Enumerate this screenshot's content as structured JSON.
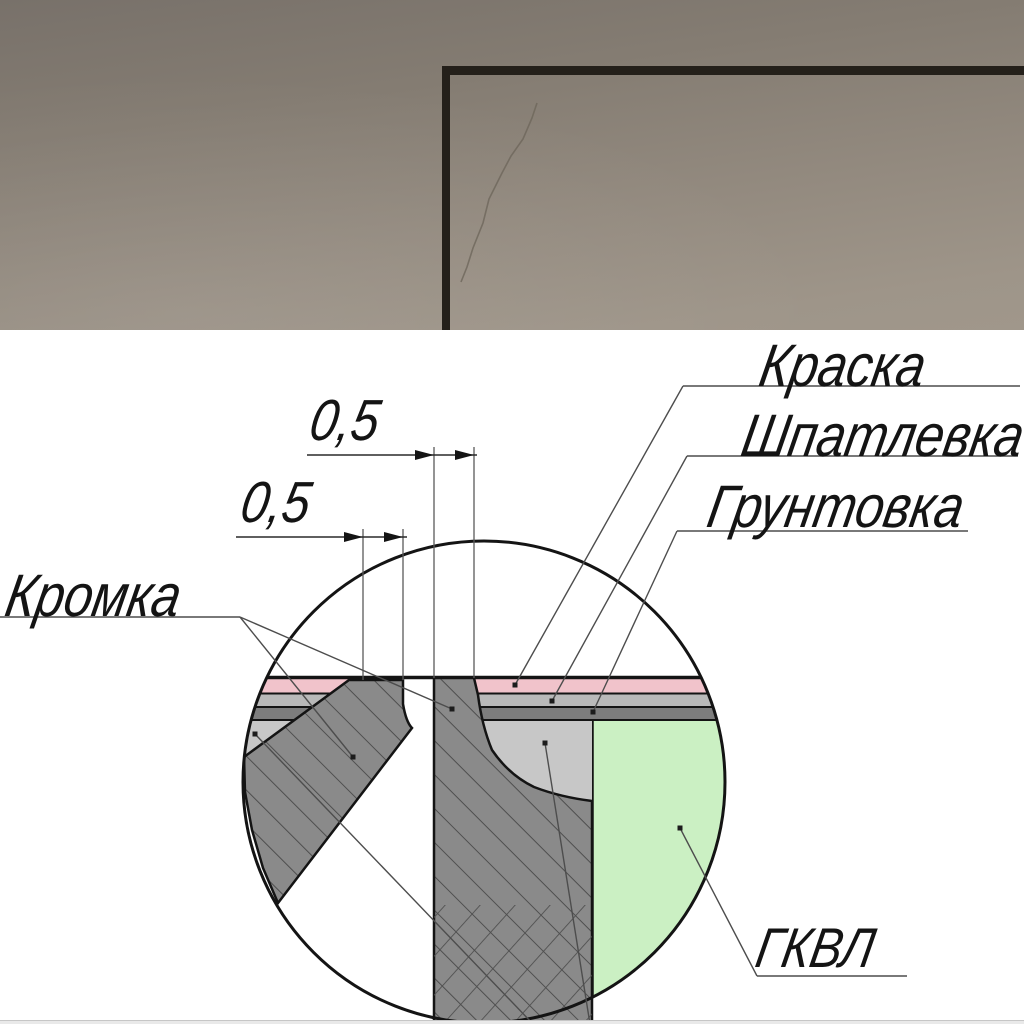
{
  "photo": {
    "wall_top_color": "#78716a",
    "wall_bottom_color": "#a0978b",
    "corner_line_color": "#24201a",
    "crack_color": "#6e665b"
  },
  "diagram": {
    "dim_top": "0,5",
    "dim_bottom": "0,5",
    "labels": {
      "paint": "Краска",
      "putty": "Шпатлевка",
      "primer": "Грунтовка",
      "edge": "Кромка",
      "board": "ГКВЛ"
    },
    "colors": {
      "paint": "#f1c3cb",
      "putty": "#b9b9b9",
      "primer": "#7d7d7d",
      "board": "#cbf0c3",
      "edge_fill": "#8a8a8a",
      "edge_hatch": "#4f4f4f",
      "putty_fill": "#c7c7c7",
      "outline": "#141414"
    }
  }
}
